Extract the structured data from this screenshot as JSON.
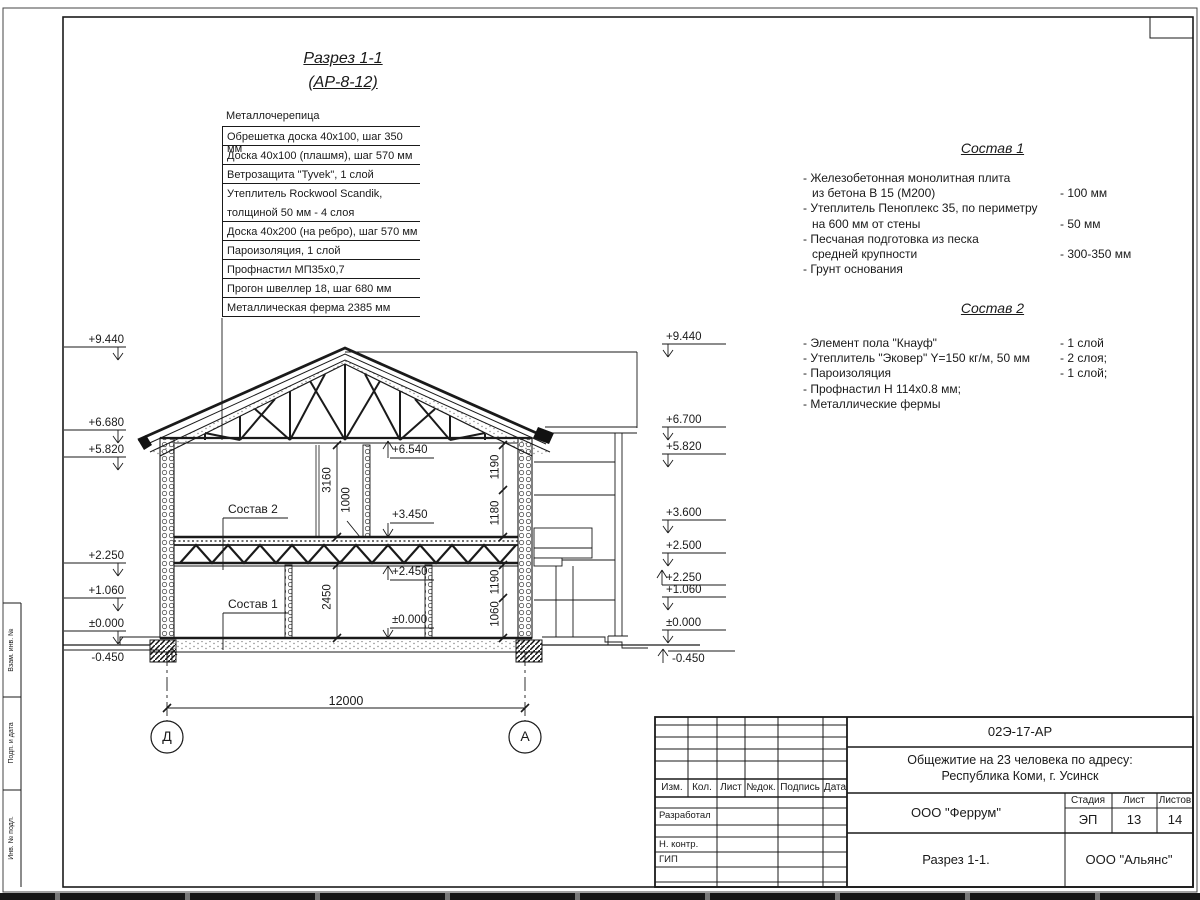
{
  "doc": {
    "title_line1": "Разрез 1-1",
    "title_line2": "(АР-8-12)"
  },
  "roof_layers": {
    "top_label": "Металлочерепица",
    "rows": [
      "Обрешетка доска 40х100, шаг 350 мм",
      "Доска 40х100 (плашмя), шаг 570 мм",
      "Ветрозащита \"Tyvek\", 1 слой",
      "Утеплитель Rockwool Scandik,",
      "толщиной 50 мм - 4 слоя",
      "Доска 40х200 (на ребро), шаг 570 мм",
      "Пароизоляция, 1 слой",
      "Профнастил МП35х0,7",
      "Прогон швеллер 18, шаг 680 мм",
      "Металлическая ферма 2385 мм"
    ]
  },
  "sostav1": {
    "title": "Состав 1",
    "lines": [
      {
        "t": "- Железобетонная  монолитная плита",
        "s": ""
      },
      {
        "t": "из бетона В 15 (М200)",
        "s": "- 100 мм"
      },
      {
        "t": "- Утеплитель Пеноплекс 35, по периметру",
        "s": ""
      },
      {
        "t": "на 600 мм от стены",
        "s": "- 50 мм"
      },
      {
        "t": "- Песчаная подготовка из песка",
        "s": ""
      },
      {
        "t": "средней крупности",
        "s": "- 300-350 мм"
      },
      {
        "t": "- Грунт основания",
        "s": ""
      }
    ]
  },
  "sostav2": {
    "title": "Состав 2",
    "lines": [
      {
        "t": "- Элемент пола \"Кнауф\"",
        "s": "- 1 слой"
      },
      {
        "t": "- Утеплитель \"Эковер\" Y=150 кг/м, 50 мм",
        "s": "- 2 слоя;"
      },
      {
        "t": "- Пароизоляция",
        "s": "- 1 слой;"
      },
      {
        "t": "- Профнастил Н 114х0.8 мм;",
        "s": ""
      },
      {
        "t": "- Металлические фермы",
        "s": ""
      }
    ]
  },
  "marks": {
    "left": [
      "+9.440",
      "+6.680",
      "+5.820",
      "+2.250",
      "+1.060",
      "±0.000",
      "-0.450"
    ],
    "right": [
      "+9.440",
      "+6.700",
      "+5.820",
      "+3.600",
      "+2.500",
      "+2.250",
      "+1.060",
      "±0.000",
      "-0.450"
    ],
    "interior": [
      "+6.540",
      "+3.450",
      "+2.450",
      "±0.000"
    ]
  },
  "dims": {
    "span": "12000",
    "h2_room": "3160",
    "h2_floor": "1000",
    "h1_room": "2450",
    "r_up1": "1190",
    "r_up2": "1180",
    "r_low1": "1190",
    "r_low2": "1060"
  },
  "axes": {
    "left": "Д",
    "right": "А"
  },
  "callouts": {
    "c2": "Состав 2",
    "c1": "Состав 1"
  },
  "titleblock": {
    "doc_number": "02Э-17-АР",
    "project_line1": "Общежитие на 23 человека по адресу:",
    "project_line2": "Республика Коми, г. Усинск",
    "header": {
      "izm": "Изм.",
      "kol": "Кол.",
      "list": "Лист",
      "ndok": "№док.",
      "podpis": "Подпись",
      "data": "Дата"
    },
    "roles": {
      "developed": "Разработал",
      "ncontr": "Н. контр.",
      "gip": "ГИП"
    },
    "org_designer": "ООО \"Феррум\"",
    "stage_label": "Стадия",
    "sheet_label": "Лист",
    "sheets_label": "Листов",
    "stage": "ЭП",
    "sheet": "13",
    "sheets": "14",
    "drawing_name": "Разрез 1-1.",
    "org_contractor": "ООО \"Альянс\""
  },
  "frame": {
    "side1": "Взам. инв. №",
    "side2": "Подп. и дата",
    "side3": "Инв. № подл."
  }
}
